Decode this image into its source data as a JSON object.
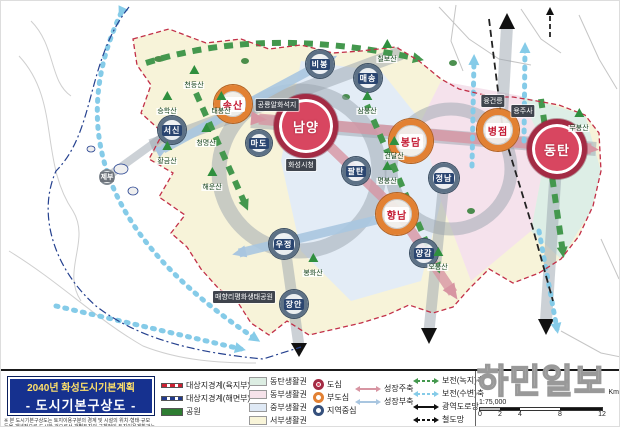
{
  "title_block": {
    "line1": "2040년 화성도시기본계획",
    "line2": "- 도시기본구상도 -",
    "disclaimer": "※ 본 도시기본구상도는 토지이용구분의 경계 및 시설의 위치·형태·규모 등을 개념적으로 도시한 것으로서 개별토지의 구체적인 토지이용계획과는 직접적인 관련이 없음"
  },
  "legend": {
    "boundaries": [
      {
        "label": "대상지경계(육지부)",
        "style": "red-dashed",
        "color": "#cc2233"
      },
      {
        "label": "대상지경계(해면부)",
        "style": "blue-dashed",
        "color": "#223a8c"
      },
      {
        "label": "공원",
        "style": "green-fill",
        "color": "#2e7d32"
      }
    ],
    "zones": [
      {
        "label": "동탄생활권",
        "color": "#dcede2"
      },
      {
        "label": "동부생활권",
        "color": "#f6e2ea"
      },
      {
        "label": "중부생활권",
        "color": "#dfe9f5"
      },
      {
        "label": "서부생활권",
        "color": "#f9f5d9"
      }
    ],
    "centers": [
      {
        "label": "도심",
        "style": "red-filled-circle"
      },
      {
        "label": "부도심",
        "style": "orange-ring"
      },
      {
        "label": "지역중심",
        "style": "navy-ring"
      }
    ],
    "axes": [
      {
        "label": "성장주축",
        "color": "#d795a2"
      },
      {
        "label": "성장부축",
        "color": "#a9c6e0"
      },
      {
        "label": "보전(녹지)축",
        "color": "#44984e"
      },
      {
        "label": "보전(수변)축",
        "color": "#85cbe8"
      },
      {
        "label": "광역도로망",
        "color": "#111111"
      },
      {
        "label": "철도망",
        "color": "#111111"
      }
    ]
  },
  "scale": {
    "ratio": "1:75,000",
    "ticks": [
      "0",
      "2",
      "4",
      "8",
      "12"
    ],
    "unit": "Km"
  },
  "watermark": "하민일보",
  "map": {
    "centers": [
      {
        "label": "남양",
        "type": "core"
      },
      {
        "label": "동탄",
        "type": "core"
      },
      {
        "label": "송산",
        "type": "sub"
      },
      {
        "label": "봉담",
        "type": "sub"
      },
      {
        "label": "병점",
        "type": "sub"
      },
      {
        "label": "향남",
        "type": "sub"
      },
      {
        "label": "서신",
        "type": "regional"
      },
      {
        "label": "마도",
        "type": "regional"
      },
      {
        "label": "팔탄",
        "type": "regional"
      },
      {
        "label": "정남",
        "type": "regional"
      },
      {
        "label": "양감",
        "type": "regional"
      },
      {
        "label": "우정",
        "type": "regional"
      },
      {
        "label": "장안",
        "type": "regional"
      },
      {
        "label": "비봉",
        "type": "regional"
      },
      {
        "label": "매송",
        "type": "regional"
      },
      {
        "label": "제부",
        "type": "island"
      }
    ],
    "mountains": [
      {
        "label": "칠보산"
      },
      {
        "label": "천등산"
      },
      {
        "label": "태봉산"
      },
      {
        "label": "승학산"
      },
      {
        "label": "청명산"
      },
      {
        "label": "황금산"
      },
      {
        "label": "해운산"
      },
      {
        "label": "삼봉산"
      },
      {
        "label": "건달산"
      },
      {
        "label": "명봉산"
      },
      {
        "label": "무봉산"
      },
      {
        "label": "오봉산"
      },
      {
        "label": "봉화산"
      }
    ],
    "landmarks": [
      {
        "label": "공룡알화석지"
      },
      {
        "label": "화성시청"
      },
      {
        "label": "융건릉"
      },
      {
        "label": "용주사"
      },
      {
        "label": "매향리평화생태공원"
      }
    ]
  }
}
